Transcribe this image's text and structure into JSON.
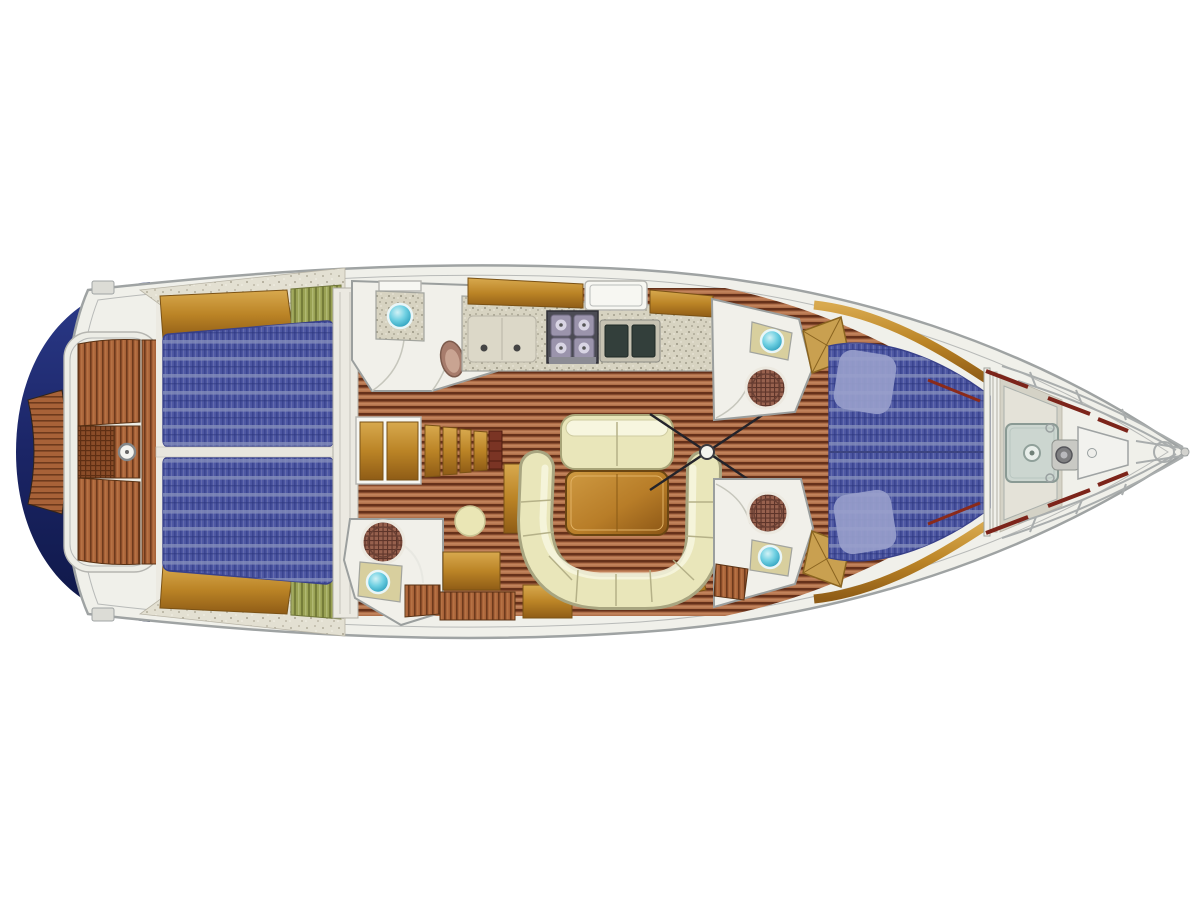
{
  "figure": {
    "kind": "yacht-deck-plan",
    "description": "Top-down interior layout plan of a sailing yacht, bow to the right, on a white background. No text labels are rendered in the image."
  },
  "canvas": {
    "width": 1200,
    "height": 900,
    "background": "#ffffff"
  },
  "palette": {
    "deck-white": "#f0f0ea",
    "deck-line": "#9fa3a3",
    "hull-navy": "#1e2a6b",
    "hull-navy-dark": "#0e1746",
    "sole-base": "#b0704a",
    "sole-dark": "#66311a",
    "teak-orange": "#a86238",
    "gold-wood": "#c9952f",
    "mattress-blue": "#4c56a2",
    "mattress-stripe": "#3b4590",
    "mattress-band": "#8790bc",
    "cushion-green": "#9aa254",
    "cream": "#e9e6ba",
    "cream-hi": "#f7f6df",
    "table-wood": "#b87d28",
    "sink-teal": "#35b6d2",
    "shower-brown": "#97614e",
    "stove-dark": "#4b4b54",
    "basin-dark": "#333f3b",
    "counter-speckle": "#d7d3c1",
    "red-accent": "#7c241a"
  },
  "regions": [
    {
      "id": "stern-hull",
      "label": "navy stern hull"
    },
    {
      "id": "swim-platform",
      "label": "teak swim platform"
    },
    {
      "id": "cockpit",
      "label": "cockpit with teak benches, grating and wheel"
    },
    {
      "id": "port-aft-cabin",
      "label": "port aft cabin double berth"
    },
    {
      "id": "starboard-aft-cabin",
      "label": "starboard aft cabin double berth"
    },
    {
      "id": "port-head",
      "label": "port head with sink and toilet"
    },
    {
      "id": "galley",
      "label": "galley with stove and double sink"
    },
    {
      "id": "companionway-stairs",
      "label": "companionway stairs"
    },
    {
      "id": "starboard-shower-head",
      "label": "starboard head with shower and sink"
    },
    {
      "id": "salon",
      "label": "salon with U-settee, table and bench"
    },
    {
      "id": "mast",
      "label": "mast with rigging tie rods"
    },
    {
      "id": "port-forward-head",
      "label": "port forward head with sink and shower"
    },
    {
      "id": "starboard-forward-head",
      "label": "starboard forward head with shower and sink"
    },
    {
      "id": "forward-cabin",
      "label": "forward owner cabin V-berth"
    },
    {
      "id": "anchor-locker",
      "label": "anchor locker with hatch and windlass"
    },
    {
      "id": "bow-pulpit",
      "label": "bow pulpit and anchor roller"
    }
  ]
}
